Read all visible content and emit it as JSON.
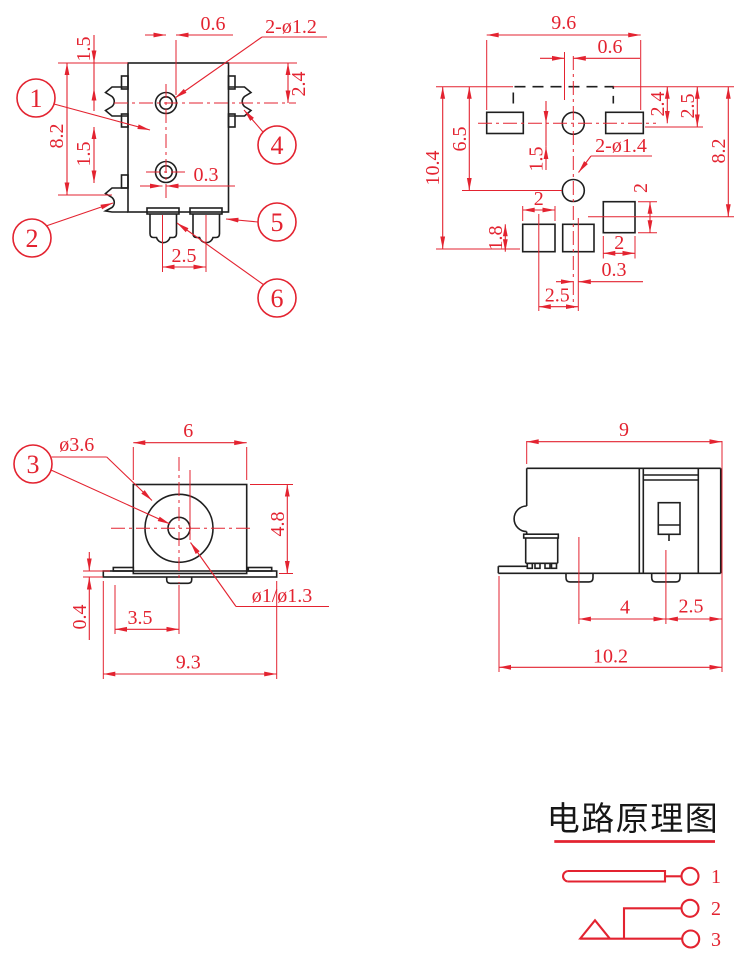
{
  "colors": {
    "line_red": "#e32330",
    "line_black": "#1f1f1f",
    "background": "#ffffff"
  },
  "views": {
    "top_left": {
      "dims": {
        "d06": "0.6",
        "holes": "2-ø1.2",
        "d15a": "1.5",
        "d82": "8.2",
        "d15b": "1.5",
        "d24": "2.4",
        "d03": "0.3",
        "d25": "2.5"
      },
      "balloons": {
        "b1": "1",
        "b2": "2",
        "b4": "4",
        "b5": "5",
        "b6": "6"
      }
    },
    "top_right": {
      "dims": {
        "d96": "9.6",
        "d06": "0.6",
        "d104": "10.4",
        "d65": "6.5",
        "d15": "1.5",
        "holes": "2-ø1.4",
        "d24": "2.4",
        "d25a": "2.5",
        "d82": "8.2",
        "d2a": "2",
        "d18": "1.8",
        "d2c": "2",
        "d2b": "2",
        "d03": "0.3",
        "d25b": "2.5"
      }
    },
    "mid_left": {
      "dims": {
        "d6": "6",
        "dia36": "ø3.6",
        "d48": "4.8",
        "dia13": "ø1/ø1.3",
        "d04": "0.4",
        "d35": "3.5",
        "d93": "9.3"
      },
      "balloons": {
        "b3": "3"
      }
    },
    "mid_right": {
      "dims": {
        "d9": "9",
        "d4": "4",
        "d25": "2.5",
        "d102": "10.2"
      }
    }
  },
  "schematic": {
    "title": "电路原理图",
    "pin1": "1",
    "pin2": "2",
    "pin3": "3"
  }
}
